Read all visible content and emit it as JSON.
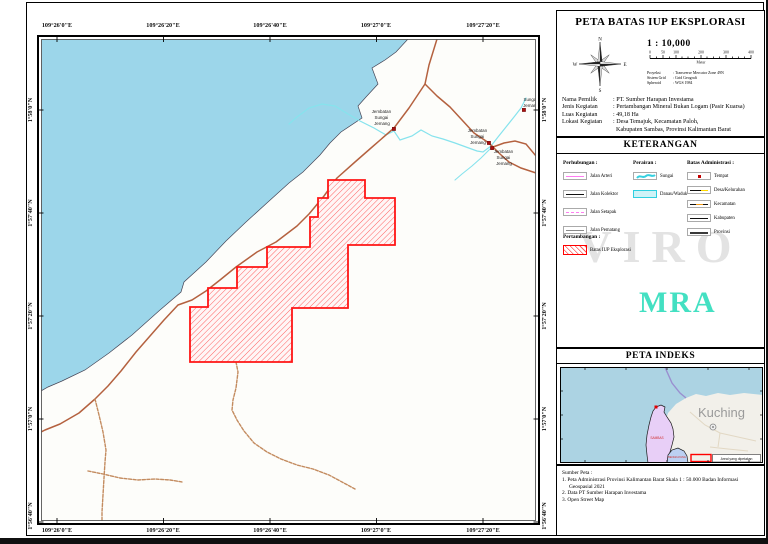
{
  "map": {
    "coords_x": [
      "109°26'0\"E",
      "109°26'20\"E",
      "109°26'40\"E",
      "109°27'0\"E",
      "109°27'20\"E"
    ],
    "coords_y": [
      "1°58'0\"N",
      "1°57'40\"N",
      "1°57'20\"N",
      "1°57'0\"N",
      "1°56'40\"N"
    ],
    "labels": {
      "bridge": [
        "Jembatan",
        "Sungai",
        "Jemang"
      ],
      "river": [
        "Sungai",
        "Jemang"
      ]
    },
    "colors": {
      "sea": "#9cd6ea",
      "road": "#b4613f",
      "track": "#c38b5f",
      "stream": "#86e3ed",
      "iup_boundary": "#ff1515",
      "point_marker": "#aa0f0f"
    }
  },
  "panel": {
    "title": "PETA BATAS IUP EKSPLORASI",
    "scale_label": "1 : 10,000",
    "scalebar": {
      "ticks": [
        "0",
        "50",
        "100",
        "200",
        "300",
        "400"
      ],
      "unit": "Meter"
    },
    "compass": {
      "n": "N",
      "e": "E",
      "s": "S",
      "w": "W"
    },
    "projection": [
      {
        "label": "Proyeksi",
        "value": ": Transverse Mercator Zone 49N"
      },
      {
        "label": "Sistem Grid",
        "value": ": Grid Geografi"
      },
      {
        "label": "Spheroid",
        "value": ": WGS 1984"
      }
    ],
    "info": [
      {
        "label": "Nama Pemilik",
        "value": ": PT. Sumber Harapan Investama"
      },
      {
        "label": "Jenis Kegiatan",
        "value": ": Pertambangan Mineral Bukan Logam (Pasir Kuarsa)"
      },
      {
        "label": "Luas Kegiatan",
        "value": ": 49,18 Ha"
      },
      {
        "label": "Lokasi Kegiatan",
        "value": ": Desa Temajuk, Kecamatan Paloh,"
      },
      {
        "label": "",
        "value": "  Kabupaten Sambas, Provinsi Kalimantan Barat"
      }
    ],
    "keterangan_title": "KETERANGAN",
    "legend": {
      "perhubungan_title": "Perhubungan :",
      "perhubungan": [
        "Jalan Arteri",
        "Jalan Kolektor",
        "Jalan Setapak",
        "Jalan Pematang"
      ],
      "perairan_title": "Perairan :",
      "perairan": [
        "Sungai",
        "Danau/Waduk"
      ],
      "batas_title": "Batas Administrasi :",
      "batas": [
        "Tempat",
        "Desa/Kelurahan",
        "Kecamatan",
        "Kabupaten",
        "Provinsi"
      ],
      "pertambangan_title": "Pertambangan :",
      "pertambangan": [
        "Batas IUP Eksplorasi"
      ]
    },
    "watermark_1": "VIRO",
    "watermark_2": "MRA",
    "index_title": "PETA INDEKS",
    "index_map": {
      "city": "Kuching",
      "region_1": "SAMBAS",
      "region_2": "BENGKAYANG",
      "marker_label": "Areal yang dipetakan"
    },
    "sources_title": "Sumber Peta :",
    "sources": [
      "1. Peta Administrasi Provinsi Kalimantan Barat Skala 1 : 50.000 Badan Informasi",
      "Geospasial 2021",
      "2. Data PT Sumber Harapan Investama",
      "3. Open Street Map"
    ]
  }
}
